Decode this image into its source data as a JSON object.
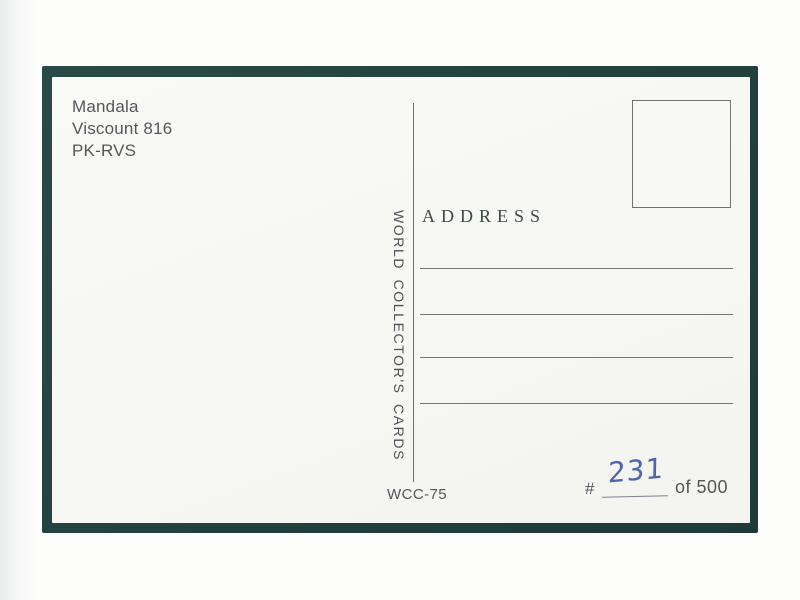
{
  "postcard": {
    "caption_lines": [
      "Mandala",
      "Viscount 816",
      "PK-RVS"
    ],
    "brand_vertical_text": "WORLD COLLECTOR'S CARDS",
    "address": {
      "label": "ADDRESS",
      "line_count": 4
    },
    "footer": {
      "card_code": "WCC-75",
      "serial_prefix": "#",
      "serial_handwritten": "231",
      "serial_suffix": "of 500"
    }
  },
  "colors": {
    "frame_green": "#24433f",
    "card_paper": "#f7f7f3",
    "background": "#fdfdfc",
    "print_gray": "#54565b",
    "address_serif": "#3e4948",
    "rule_line": "#747673",
    "handwriting_blue": "#4c66ae"
  }
}
